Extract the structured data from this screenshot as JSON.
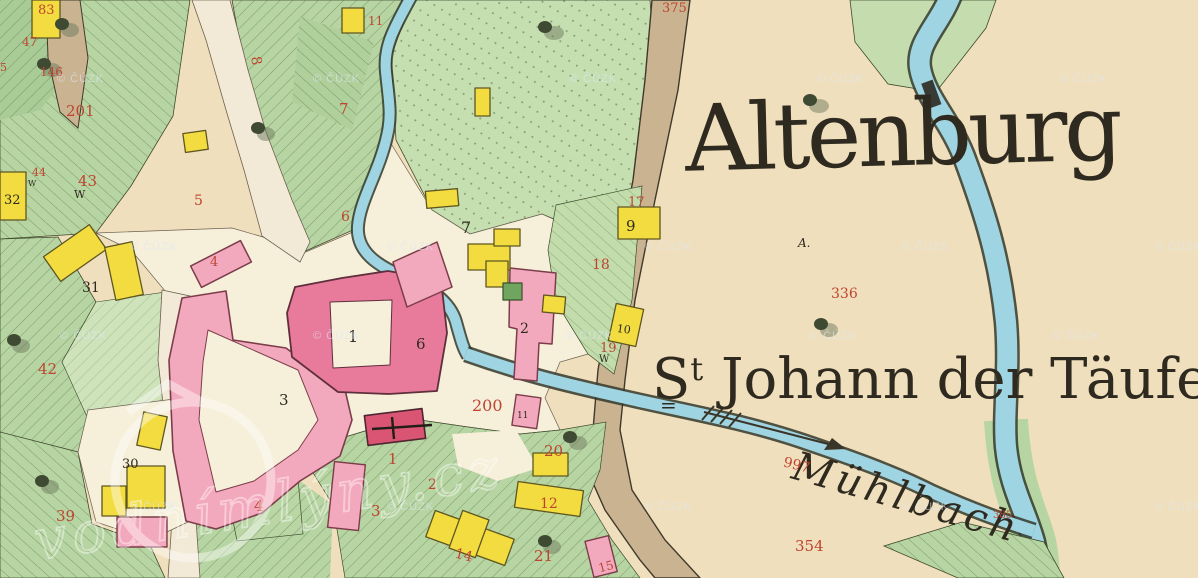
{
  "map": {
    "labels": {
      "settlement": "Altenburg",
      "church_prefix": "S",
      "church_sup": "t",
      "church_underline": "=",
      "church_rest": " Johann der Täufer",
      "stream_name": "Mühlbach",
      "survey_mark": "A."
    },
    "watermark": {
      "text": "© ČÚZK"
    },
    "logo_watermark": {
      "text": "vodnímlýny.cz"
    },
    "red_numbers": [
      {
        "t": "83"
      },
      {
        "t": "47"
      },
      {
        "t": "146"
      },
      {
        "t": "201"
      },
      {
        "t": "5"
      },
      {
        "t": "44"
      },
      {
        "t": "43"
      },
      {
        "t": "42"
      },
      {
        "t": "39"
      },
      {
        "t": "5"
      },
      {
        "t": "8"
      },
      {
        "t": "11"
      },
      {
        "t": "7"
      },
      {
        "t": "6"
      },
      {
        "t": "17"
      },
      {
        "t": "18"
      },
      {
        "t": "19"
      },
      {
        "t": "20"
      },
      {
        "t": "21"
      },
      {
        "t": "12"
      },
      {
        "t": "14"
      },
      {
        "t": "15"
      },
      {
        "t": "1"
      },
      {
        "t": "2"
      },
      {
        "t": "3"
      },
      {
        "t": "4"
      },
      {
        "t": "4"
      },
      {
        "t": "200"
      },
      {
        "t": "375"
      },
      {
        "t": "336"
      },
      {
        "t": "997"
      },
      {
        "t": "354"
      },
      {
        "t": "385"
      }
    ],
    "black_numbers": [
      {
        "t": "32"
      },
      {
        "t": "31"
      },
      {
        "t": "30"
      },
      {
        "t": "3"
      },
      {
        "t": "1"
      },
      {
        "t": "6"
      },
      {
        "t": "2"
      },
      {
        "t": "7"
      },
      {
        "t": "9"
      },
      {
        "t": "10"
      },
      {
        "t": "11"
      },
      {
        "t": "W"
      },
      {
        "t": "W"
      },
      {
        "t": "W"
      },
      {
        "t": "A."
      }
    ],
    "colors": {
      "parchment": "#f0dfbc",
      "village_ground": "#f6efda",
      "forest_green": "#b7d5a2",
      "forest_light": "#c6dfb0",
      "stream_blue": "#9fd4e2",
      "road_tan": "#c9b391",
      "building_pink": "#f3a9bd",
      "building_carmine": "#e87a9b",
      "church_red": "#d95573",
      "building_yellow": "#f2dc3f",
      "number_red": "#bf4430",
      "ink_black": "#2e2a20"
    }
  }
}
